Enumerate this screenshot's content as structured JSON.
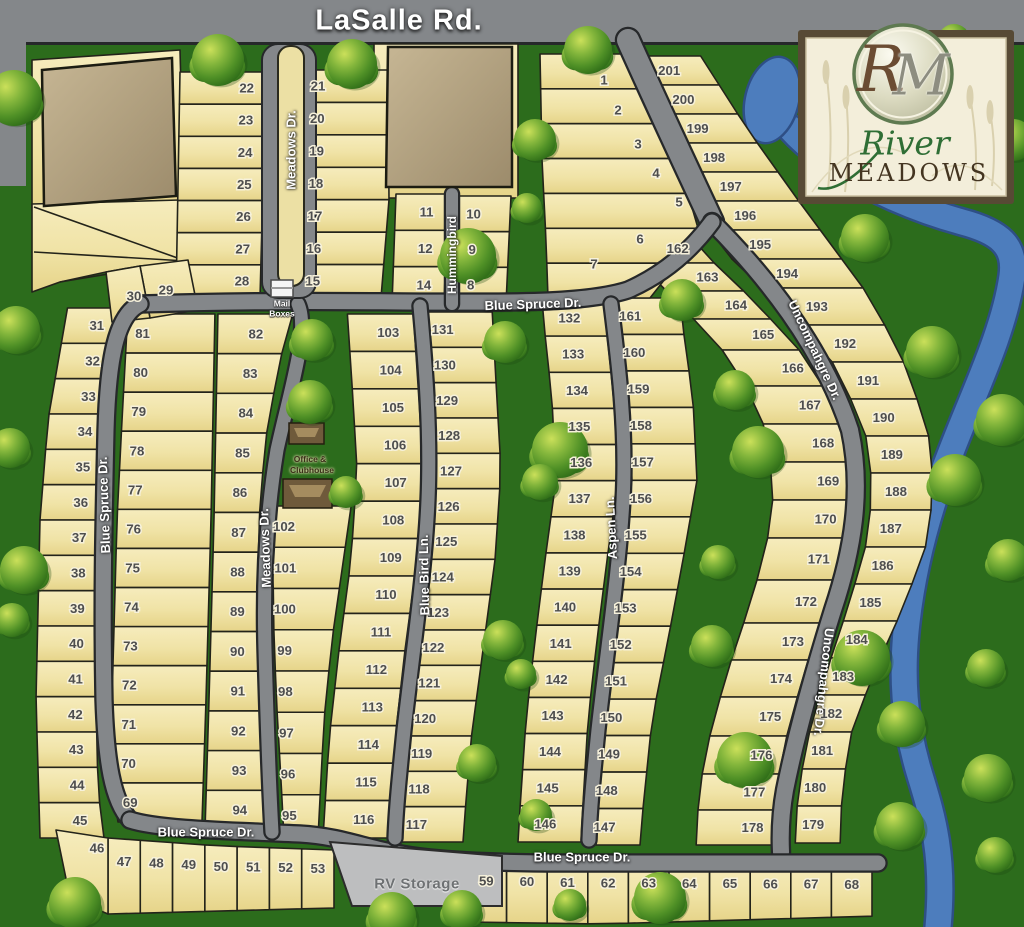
{
  "page_title": "River Meadows Community Site Map",
  "streets": {
    "lasalle": "LaSalle Rd.",
    "meadows": "Meadows Dr.",
    "blue_spruce": "Blue Spruce Dr.",
    "blue_bird": "Blue Bird Ln.",
    "aspen": "Aspen Ln.",
    "hummingbird": "Hummingbird",
    "uncompahgre": "Uncompahgre Dr."
  },
  "labels": {
    "mail_line1": "Mail",
    "mail_line2": "Boxes",
    "office_line1": "Office &",
    "office_line2": "Clubhouse",
    "rv_storage": "RV Storage"
  },
  "logo": {
    "monogram_r": "R",
    "monogram_m": "M",
    "name_line1": "River",
    "name_line2": "MEADOWS"
  },
  "colors": {
    "grass": "#2c6c1c",
    "road": "#84878a",
    "road_edge": "#26282a",
    "lot_fill": "#f0e3a6",
    "lot_edge": "#23231a",
    "water": "#4d7dbd",
    "water_edge": "#2e4f86",
    "building_tan": "#b1a081",
    "building_brown": "#6f5a3b",
    "rv_gray": "#bdbebf",
    "logo_cream": "#f3eeda",
    "logo_frame": "#574a35"
  },
  "lot_groups": {
    "west_strip": [
      31,
      32,
      33,
      34,
      35,
      36,
      37,
      38,
      39,
      40,
      41,
      42,
      43,
      44,
      45
    ],
    "col_a": [
      81,
      80,
      79,
      78,
      77,
      76,
      75,
      74,
      73,
      72,
      71,
      70,
      69
    ],
    "col_b": [
      82,
      83,
      84,
      85,
      86,
      87,
      88,
      89,
      90,
      91,
      92,
      93,
      94
    ],
    "col_c": [
      102,
      101,
      100,
      99,
      98,
      97,
      96,
      95
    ],
    "col_d": [
      103,
      104,
      105,
      106,
      107,
      108,
      109,
      110,
      111,
      112,
      113,
      114,
      115,
      116
    ],
    "col_e": [
      131,
      130,
      129,
      128,
      127,
      126,
      125,
      124,
      123,
      122,
      121,
      120,
      119,
      118,
      117
    ],
    "col_f": [
      132,
      133,
      134,
      135,
      136,
      137,
      138,
      139,
      140,
      141,
      142,
      143,
      144,
      145,
      146
    ],
    "col_g": [
      161,
      160,
      159,
      158,
      157,
      156,
      155,
      154,
      153,
      152,
      151,
      150,
      149,
      148,
      147
    ],
    "col_h": [
      162,
      163,
      164,
      165,
      166,
      167,
      168,
      169,
      170,
      171,
      172,
      173,
      174,
      175,
      176,
      177,
      178
    ],
    "col_i": [
      201,
      200,
      199,
      198,
      197,
      196,
      195,
      194,
      193,
      192,
      191,
      190,
      189,
      188,
      187,
      186,
      185,
      184,
      183,
      182,
      181,
      180,
      179
    ],
    "entry_west": [
      1,
      2,
      3,
      4,
      5,
      6,
      7
    ],
    "top_west": [
      22,
      23,
      24,
      25,
      26,
      27,
      28
    ],
    "top_mid": [
      21,
      20,
      19,
      18,
      17,
      16,
      15
    ],
    "top_hum_w": [
      11,
      12,
      14
    ],
    "top_hum_e": [
      10,
      9,
      8
    ],
    "row_sw": [
      47,
      48,
      49,
      50,
      51,
      52,
      53
    ],
    "row_se": [
      59,
      60,
      61,
      62,
      63,
      64,
      65,
      66,
      67,
      68
    ],
    "wedge_lots": [
      29,
      30,
      46
    ]
  }
}
